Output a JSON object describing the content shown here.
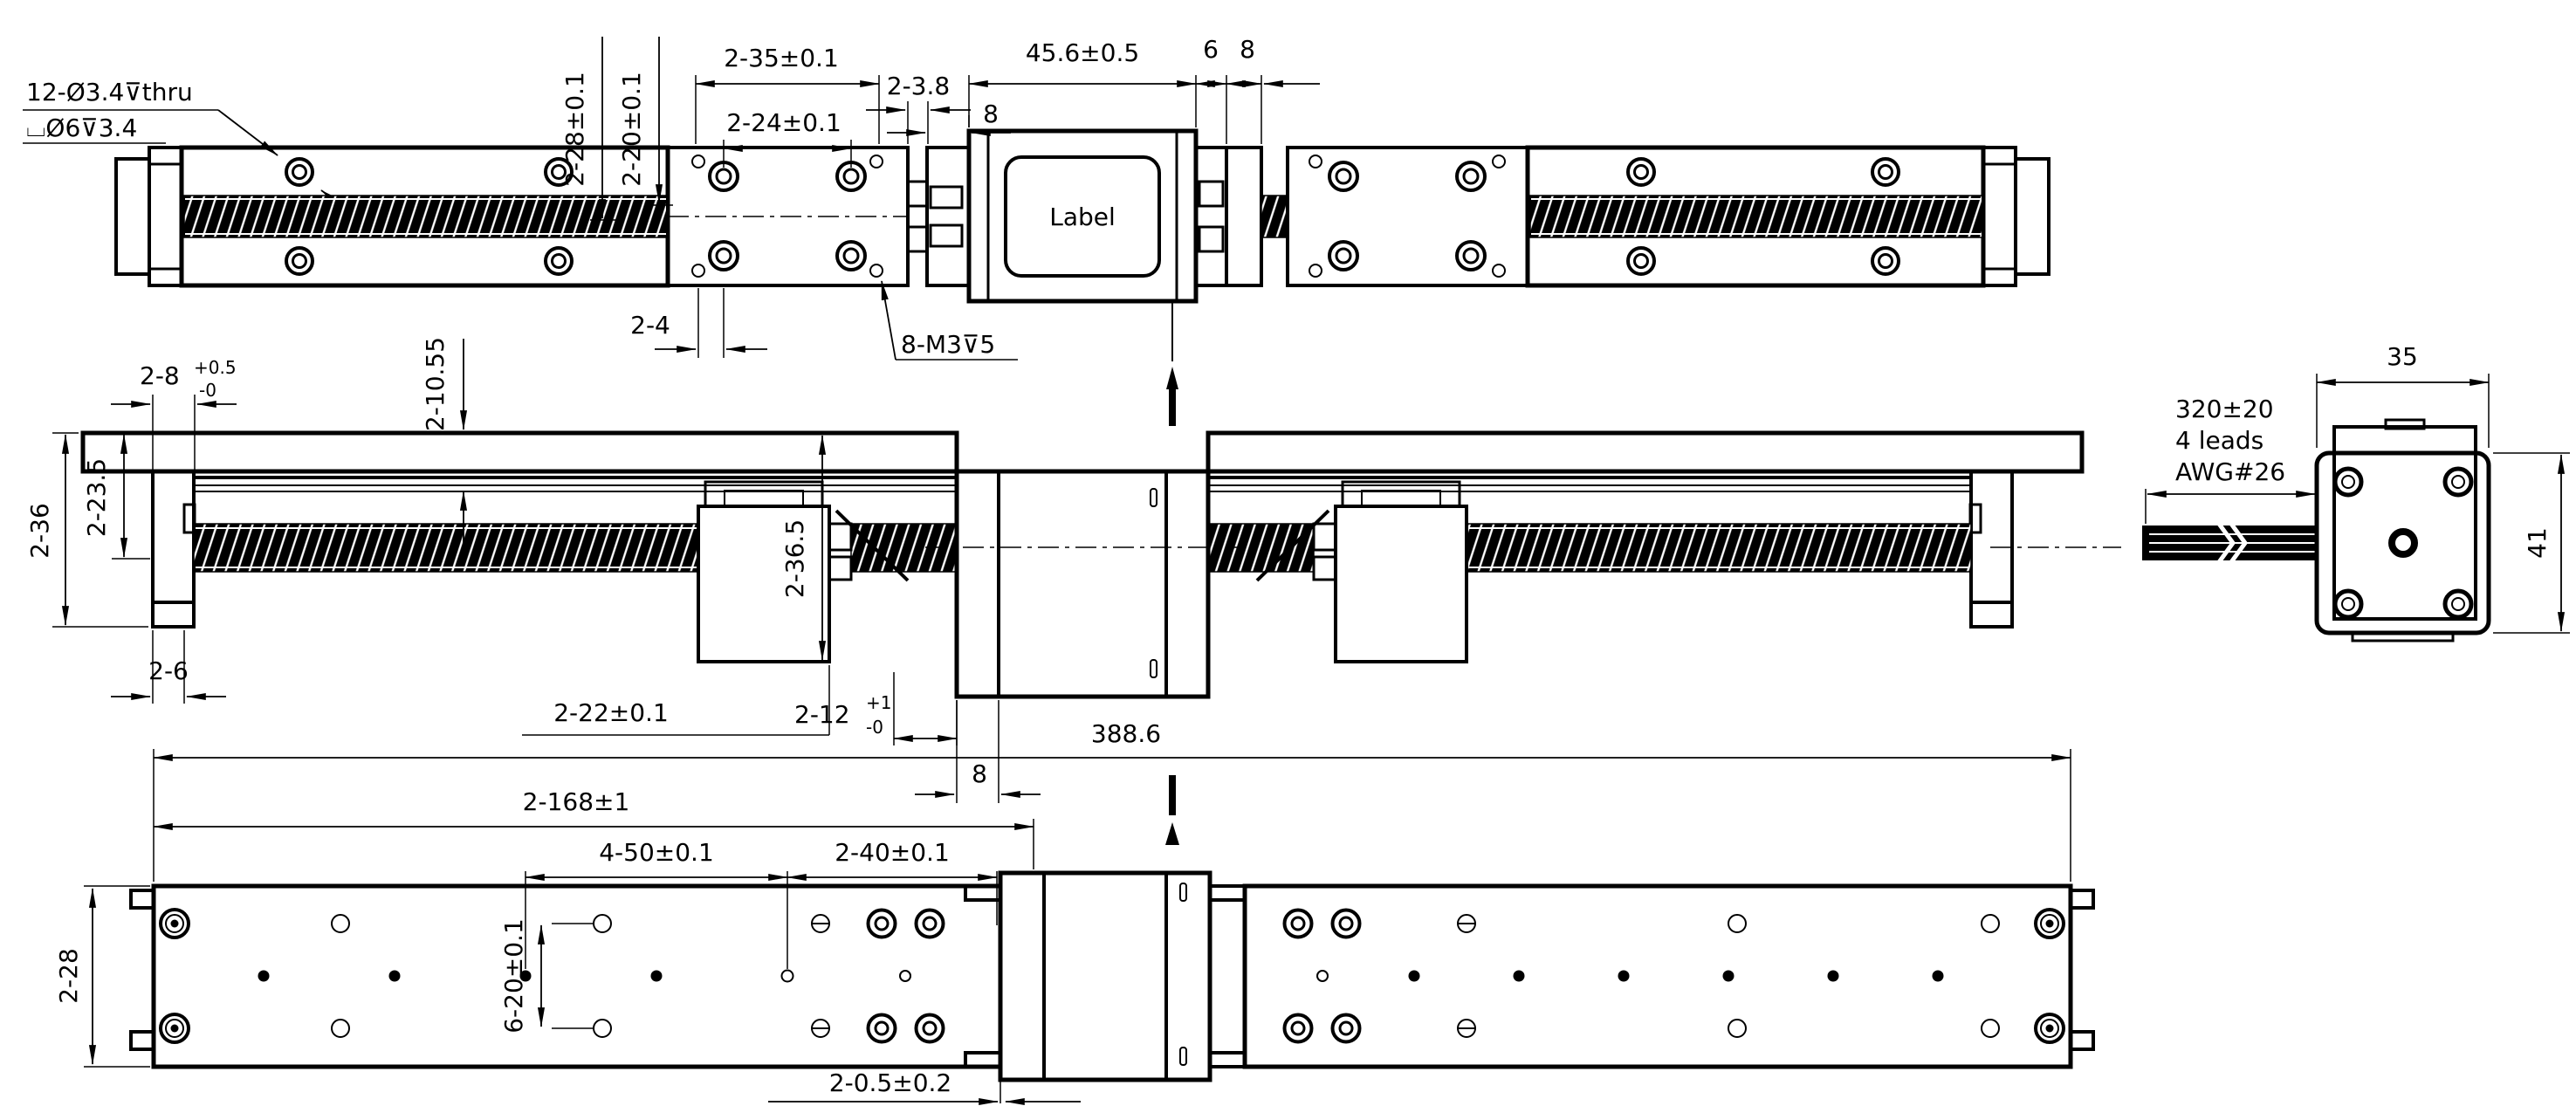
{
  "top": {
    "callout_cbore_line1": "12-Ø3.4⊽thru",
    "callout_cbore_line2": "⌴Ø6⊽3.4",
    "dim_28": "2-28±0.1",
    "dim_20": "2-20±0.1",
    "dim_35": "2-35±0.1",
    "dim_24": "2-24±0.1",
    "dim_3_8": "2-3.8",
    "dim_8_left": "8",
    "dim_45_6": "45.6±0.5",
    "dim_6": "6",
    "dim_8_right": "8",
    "dim_4": "2-4",
    "callout_tapped": "8-M3⊽5",
    "motor_label": "Label"
  },
  "front": {
    "dim_8": "2-8",
    "dim_8_tol_plus": "+0.5",
    "dim_8_tol_minus": "-0",
    "dim_10_55": "2-10.55",
    "dim_36": "2-36",
    "dim_23_5": "2-23.5",
    "dim_6": "2-6",
    "dim_22": "2-22±0.1",
    "dim_12": "2-12",
    "dim_12_tol_plus": "+1",
    "dim_12_tol_minus": "-0",
    "dim_36_5": "2-36.5",
    "dim_8_center": "8"
  },
  "bottom": {
    "dim_total": "388.6",
    "dim_168": "2-168±1",
    "dim_50": "4-50±0.1",
    "dim_40": "2-40±0.1",
    "dim_20": "6-20±0.1",
    "dim_28": "2-28",
    "dim_0_5": "2-0.5±0.2"
  },
  "motor_end": {
    "dim_width": "35",
    "dim_height": "41",
    "cable_note_1": "320±20",
    "cable_note_2": "4 leads",
    "cable_note_3": "AWG#26"
  }
}
